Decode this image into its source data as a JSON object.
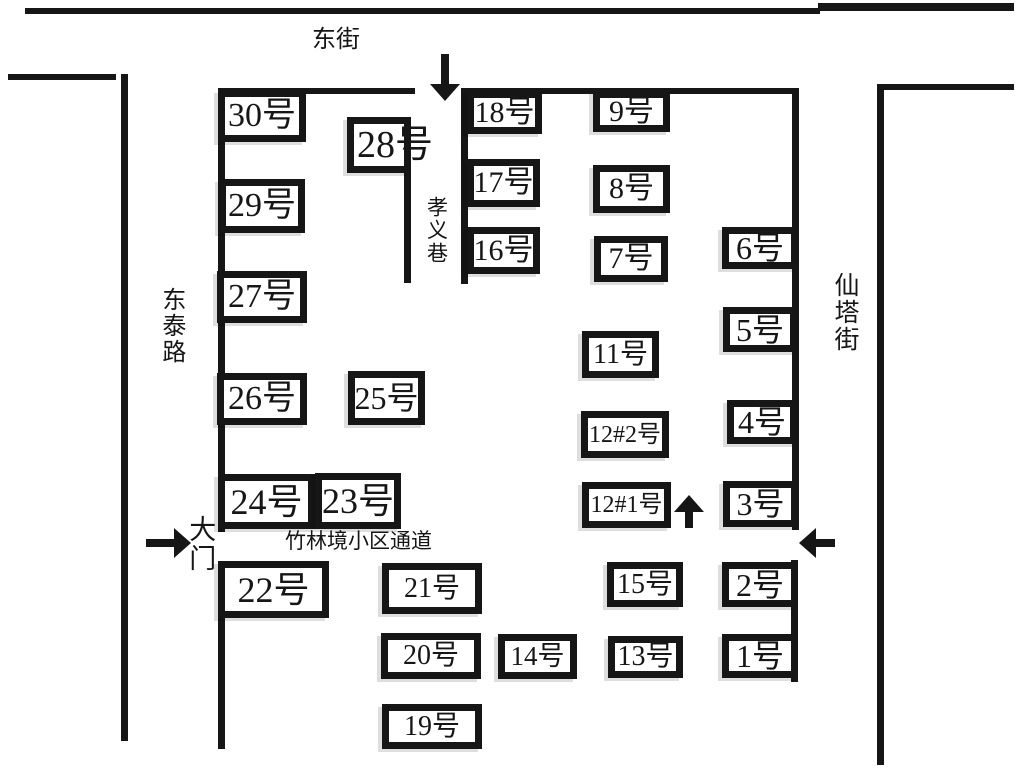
{
  "map": {
    "width": 1024,
    "height": 768,
    "colors": {
      "ink": "#161616",
      "paper": "#ffffff",
      "shadow": "#d9d9d9"
    },
    "walls": [
      {
        "id": "north-street-edge-1",
        "x": 25,
        "y": 8,
        "w": 795,
        "h": 6
      },
      {
        "id": "north-street-edge-2",
        "x": 818,
        "y": 3,
        "w": 196,
        "h": 8
      },
      {
        "id": "west-street-corner",
        "x": 8,
        "y": 74,
        "w": 108,
        "h": 6
      },
      {
        "id": "west-street-edge",
        "x": 121,
        "y": 74,
        "w": 7,
        "h": 667
      },
      {
        "id": "east-street-corner",
        "x": 877,
        "y": 84,
        "w": 137,
        "h": 6
      },
      {
        "id": "east-street-edge",
        "x": 877,
        "y": 84,
        "w": 7,
        "h": 681
      },
      {
        "id": "community-north-wall-west",
        "x": 218,
        "y": 88,
        "w": 197,
        "h": 6
      },
      {
        "id": "community-north-wall-east",
        "x": 462,
        "y": 88,
        "w": 337,
        "h": 6
      },
      {
        "id": "community-west-wall-upper",
        "x": 218,
        "y": 88,
        "w": 7,
        "h": 444
      },
      {
        "id": "community-west-wall-lower",
        "x": 218,
        "y": 561,
        "w": 7,
        "h": 188
      },
      {
        "id": "community-east-wall-upper",
        "x": 792,
        "y": 88,
        "w": 7,
        "h": 442
      },
      {
        "id": "community-east-wall-lower",
        "x": 791,
        "y": 560,
        "w": 7,
        "h": 122
      },
      {
        "id": "xiaoyi-lane-west-wall",
        "x": 404,
        "y": 170,
        "w": 7,
        "h": 113
      },
      {
        "id": "xiaoyi-lane-east-wall",
        "x": 461,
        "y": 88,
        "w": 7,
        "h": 196
      }
    ],
    "buildings": [
      {
        "id": "30",
        "label": "30号",
        "x": 218,
        "y": 90,
        "w": 88,
        "h": 52,
        "fs": 34
      },
      {
        "id": "29",
        "label": "29号",
        "x": 219,
        "y": 179,
        "w": 86,
        "h": 54,
        "fs": 34
      },
      {
        "id": "27",
        "label": "27号",
        "x": 217,
        "y": 271,
        "w": 90,
        "h": 52,
        "fs": 34
      },
      {
        "id": "26",
        "label": "26号",
        "x": 217,
        "y": 373,
        "w": 90,
        "h": 52,
        "fs": 34
      },
      {
        "id": "24",
        "label": "24号",
        "x": 218,
        "y": 474,
        "w": 97,
        "h": 55,
        "fs": 36
      },
      {
        "id": "23",
        "label": "23号",
        "x": 315,
        "y": 473,
        "w": 86,
        "h": 56,
        "fs": 36
      },
      {
        "id": "22",
        "label": "22号",
        "x": 218,
        "y": 561,
        "w": 111,
        "h": 57,
        "fs": 36
      },
      {
        "id": "28",
        "label": "28号",
        "x": 347,
        "y": 117,
        "w": 64,
        "h": 56,
        "fs": 38,
        "ovf": true
      },
      {
        "id": "25",
        "label": "25号",
        "x": 348,
        "y": 371,
        "w": 77,
        "h": 54,
        "fs": 32
      },
      {
        "id": "21",
        "label": "21号",
        "x": 382,
        "y": 563,
        "w": 100,
        "h": 51,
        "fs": 28
      },
      {
        "id": "20",
        "label": "20号",
        "x": 381,
        "y": 633,
        "w": 100,
        "h": 46,
        "fs": 28
      },
      {
        "id": "19",
        "label": "19号",
        "x": 382,
        "y": 704,
        "w": 100,
        "h": 45,
        "fs": 28
      },
      {
        "id": "18",
        "label": "18号",
        "x": 467,
        "y": 91,
        "w": 75,
        "h": 43,
        "fs": 30
      },
      {
        "id": "17",
        "label": "17号",
        "x": 467,
        "y": 159,
        "w": 73,
        "h": 48,
        "fs": 30
      },
      {
        "id": "16",
        "label": "16号",
        "x": 467,
        "y": 227,
        "w": 73,
        "h": 47,
        "fs": 30
      },
      {
        "id": "9",
        "label": "9号",
        "x": 593,
        "y": 91,
        "w": 77,
        "h": 41,
        "fs": 30
      },
      {
        "id": "8",
        "label": "8号",
        "x": 593,
        "y": 165,
        "w": 77,
        "h": 48,
        "fs": 30
      },
      {
        "id": "7",
        "label": "7号",
        "x": 594,
        "y": 236,
        "w": 74,
        "h": 46,
        "fs": 30
      },
      {
        "id": "11",
        "label": "11号",
        "x": 582,
        "y": 331,
        "w": 77,
        "h": 47,
        "fs": 28
      },
      {
        "id": "12-2",
        "label": "12#2号",
        "x": 581,
        "y": 411,
        "w": 88,
        "h": 47,
        "fs": 24
      },
      {
        "id": "12-1",
        "label": "12#1号",
        "x": 582,
        "y": 482,
        "w": 89,
        "h": 46,
        "fs": 24
      },
      {
        "id": "15",
        "label": "15号",
        "x": 607,
        "y": 562,
        "w": 76,
        "h": 45,
        "fs": 28
      },
      {
        "id": "13",
        "label": "13号",
        "x": 608,
        "y": 636,
        "w": 75,
        "h": 42,
        "fs": 28
      },
      {
        "id": "14",
        "label": "14号",
        "x": 498,
        "y": 634,
        "w": 79,
        "h": 45,
        "fs": 27
      },
      {
        "id": "6",
        "label": "6号",
        "x": 722,
        "y": 227,
        "w": 76,
        "h": 42,
        "fs": 32
      },
      {
        "id": "5",
        "label": "5号",
        "x": 723,
        "y": 307,
        "w": 74,
        "h": 45,
        "fs": 32
      },
      {
        "id": "4",
        "label": "4号",
        "x": 727,
        "y": 400,
        "w": 70,
        "h": 44,
        "fs": 32
      },
      {
        "id": "3",
        "label": "3号",
        "x": 723,
        "y": 481,
        "w": 75,
        "h": 46,
        "fs": 32
      },
      {
        "id": "2",
        "label": "2号",
        "x": 722,
        "y": 562,
        "w": 76,
        "h": 45,
        "fs": 32
      },
      {
        "id": "1",
        "label": "1号",
        "x": 722,
        "y": 634,
        "w": 76,
        "h": 44,
        "fs": 32
      }
    ],
    "labels": [
      {
        "id": "dong-jie-street",
        "text": "东街",
        "x": 312,
        "y": 27,
        "fs": 24,
        "vertical": false
      },
      {
        "id": "dong-tai-lu-road",
        "text": "东泰路",
        "x": 157,
        "y": 287,
        "fs": 24,
        "vertical": true
      },
      {
        "id": "xian-ta-jie-street",
        "text": "仙塔街",
        "x": 830,
        "y": 272,
        "fs": 25,
        "vertical": true
      },
      {
        "id": "xiao-yi-xiang-lane",
        "text": "孝义巷",
        "x": 424,
        "y": 196,
        "fs": 21,
        "vertical": true
      },
      {
        "id": "da-men-gate",
        "text": "大门",
        "x": 185,
        "y": 515,
        "fs": 27,
        "vertical": true
      },
      {
        "id": "passage",
        "text": "竹林境小区通道",
        "x": 285,
        "y": 530,
        "fs": 21,
        "vertical": false
      }
    ],
    "arrows": [
      {
        "id": "north-entrance-arrow",
        "dir": "down",
        "x": 445,
        "y": 101,
        "len": 47
      },
      {
        "id": "main-gate-arrow",
        "dir": "right",
        "x": 191,
        "y": 543,
        "len": 45
      },
      {
        "id": "east-entrance-arrow",
        "dir": "left",
        "x": 799,
        "y": 543,
        "len": 36
      },
      {
        "id": "interior-up-arrow",
        "dir": "up",
        "x": 689,
        "y": 495,
        "len": 33
      }
    ]
  }
}
